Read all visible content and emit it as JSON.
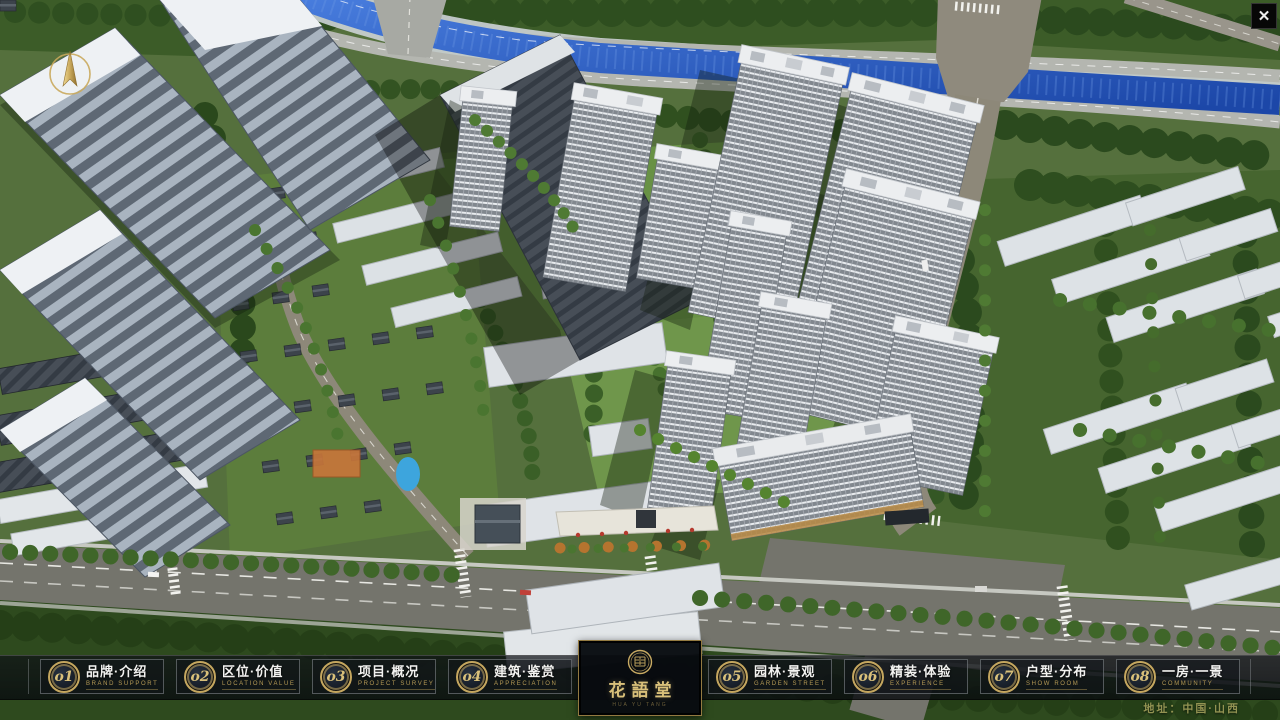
{
  "ui": {
    "close": {
      "icon": "close-x",
      "label": "✕"
    },
    "compass": {
      "icon": "north-arrow"
    }
  },
  "menu": {
    "items": [
      {
        "number": "o1",
        "zh": "品牌·介绍",
        "en": "BRAND SUPPORT"
      },
      {
        "number": "o2",
        "zh": "区位·价值",
        "en": "LOCATION VALUE"
      },
      {
        "number": "o3",
        "zh": "项目·概况",
        "en": "PROJECT SURVEY"
      },
      {
        "number": "o4",
        "zh": "建筑·鉴赏",
        "en": "APPRECIATION"
      },
      {
        "number": "o5",
        "zh": "园林·景观",
        "en": "GARDEN STREET"
      },
      {
        "number": "o6",
        "zh": "精装·体验",
        "en": "EXPERIENCE"
      },
      {
        "number": "o7",
        "zh": "户型·分布",
        "en": "SHOW ROOM"
      },
      {
        "number": "o8",
        "zh": "一房·一景",
        "en": "COMMUNITY"
      }
    ]
  },
  "logo": {
    "name": "花語堂",
    "subtitle": "HUA YU TANG"
  },
  "footer": {
    "address": "地址：中国·山西"
  },
  "colors": {
    "gold": "#c9ab63",
    "bar_bg": "#0d1116",
    "water": "#2a56bb",
    "accent_red": "#b53a2e"
  }
}
